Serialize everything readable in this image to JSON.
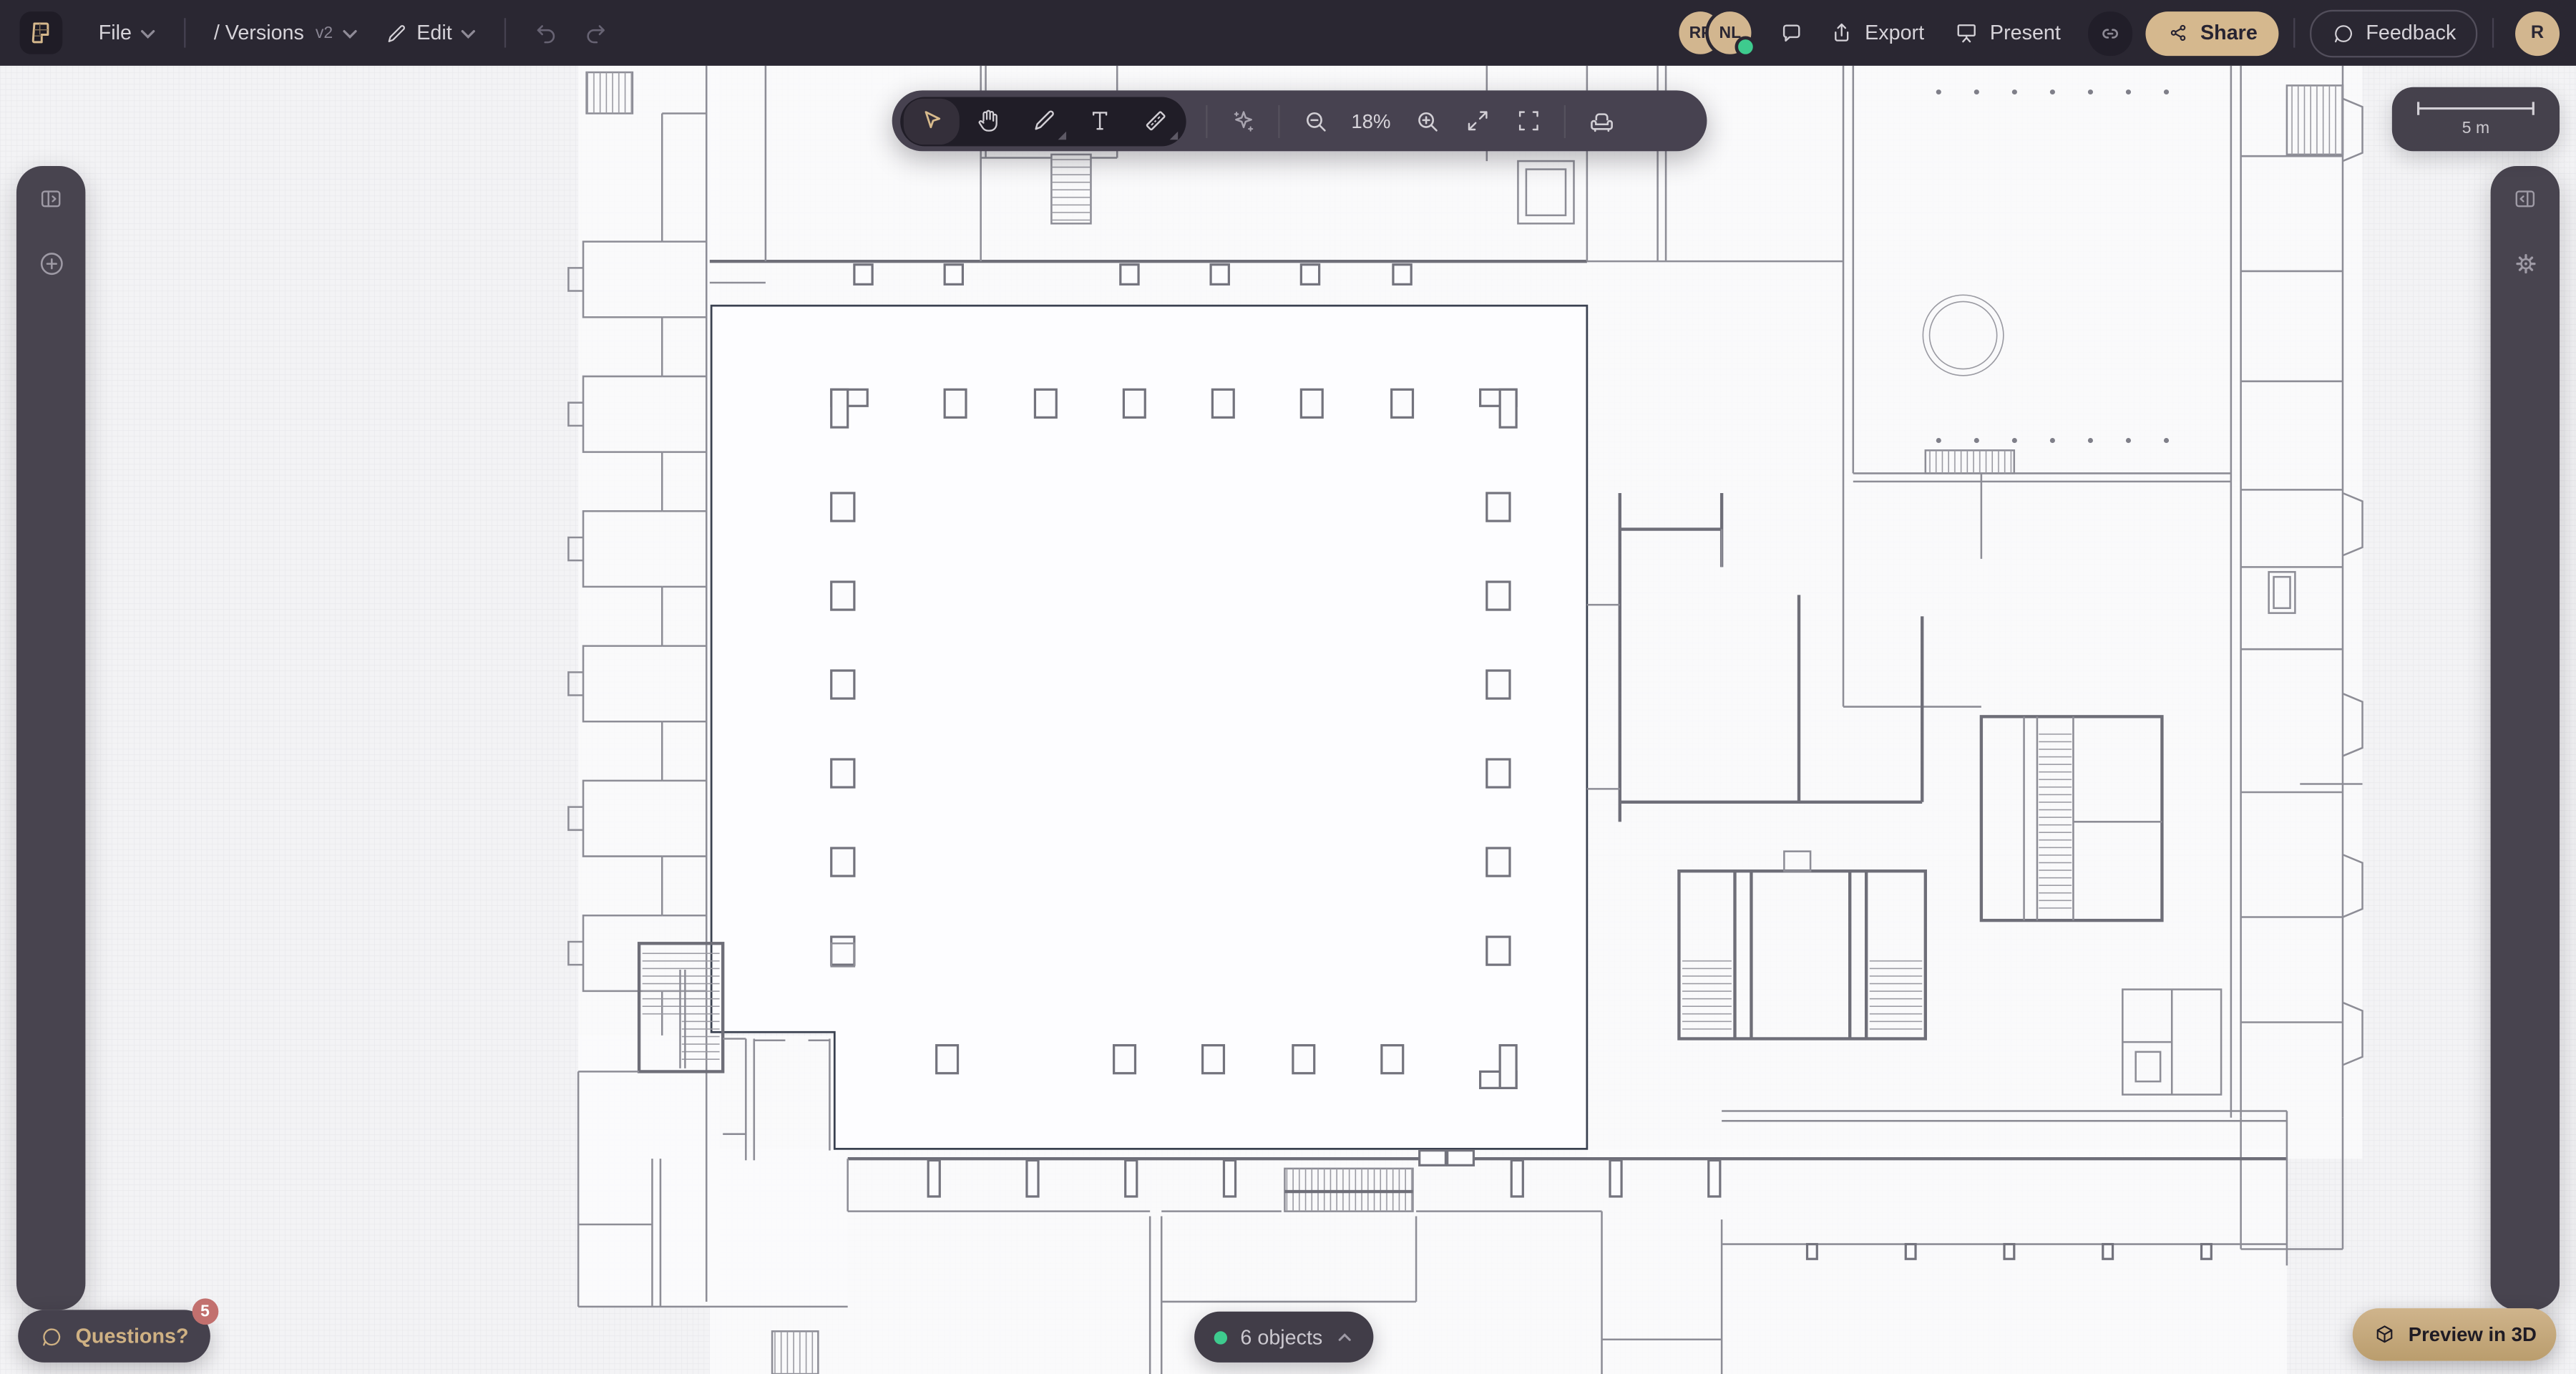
{
  "topbar": {
    "file_menu": "File",
    "versions_label": "/ Versions",
    "version_tag": "v2",
    "edit_menu": "Edit",
    "collaborators": [
      {
        "initials": "RP"
      },
      {
        "initials": "NL",
        "online": true
      }
    ],
    "export_label": "Export",
    "present_label": "Present",
    "share_label": "Share",
    "feedback_label": "Feedback",
    "user_initial": "R"
  },
  "toolbar": {
    "tools": [
      "select",
      "pan",
      "draw",
      "text",
      "measure"
    ],
    "selected_tool": "select",
    "actions": [
      "ai-assistant",
      "zoom-out",
      "zoom-in",
      "fit-view",
      "fullscreen",
      "furniture-library"
    ],
    "zoom_level": "18%"
  },
  "scale_bar": {
    "label": "5 m"
  },
  "status_bar": {
    "objects_label": "6 objects"
  },
  "help_button": {
    "label": "Questions?",
    "badge": "5"
  },
  "preview_button": {
    "label": "Preview in 3D"
  },
  "colors": {
    "topbar_bg": "#2a2732",
    "panel_bg": "#47434e",
    "accent_gold": "#d6b88c",
    "selection_navy": "#3a4150",
    "online_green": "#3ecb8e",
    "badge_red": "#c2706e",
    "canvas_bg": "#f3f3f5"
  }
}
